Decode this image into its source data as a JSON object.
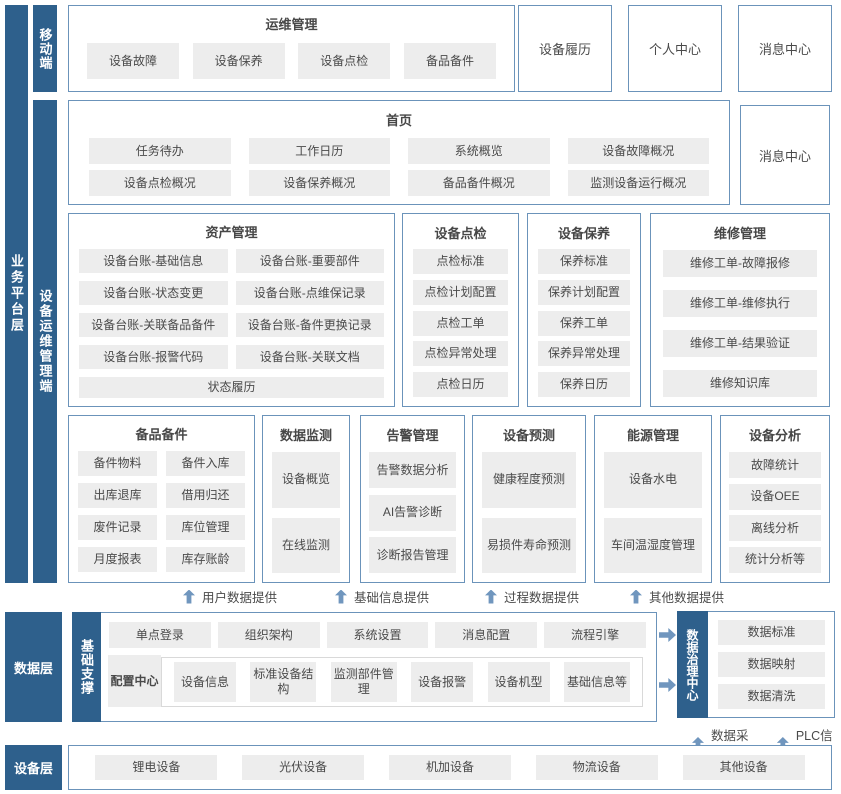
{
  "colors": {
    "dark_blue": "#2e608c",
    "border_blue": "#6b93ba",
    "item_gray": "#ededed",
    "arrow_blue": "#7096be"
  },
  "bars": {
    "business": "业务平台层",
    "mobile": "移动端",
    "ops": "设备运维管理端"
  },
  "yunwei": {
    "title": "运维管理",
    "items": [
      "设备故障",
      "设备保养",
      "设备点检",
      "备品备件"
    ]
  },
  "top_boxes": {
    "b0": "设备履历",
    "b1": "个人中心",
    "b2": "消息中心"
  },
  "home": {
    "title": "首页",
    "items": [
      "任务待办",
      "工作日历",
      "系统概览",
      "设备故障概况",
      "设备点检概况",
      "设备保养概况",
      "备品备件概况",
      "监测设备运行概况"
    ],
    "side": "消息中心"
  },
  "asset": {
    "title": "资产管理",
    "items": [
      "设备台账-基础信息",
      "设备台账-重要部件",
      "设备台账-状态变更",
      "设备台账-点维保记录",
      "设备台账-关联备品备件",
      "设备台账-备件更换记录",
      "设备台账-报警代码",
      "设备台账-关联文档"
    ],
    "wide": "状态履历"
  },
  "dianjian": {
    "title": "设备点检",
    "items": [
      "点检标准",
      "点检计划配置",
      "点检工单",
      "点检异常处理",
      "点检日历"
    ]
  },
  "baoyang": {
    "title": "设备保养",
    "items": [
      "保养标准",
      "保养计划配置",
      "保养工单",
      "保养异常处理",
      "保养日历"
    ]
  },
  "weixiu": {
    "title": "维修管理",
    "items": [
      "维修工单-故障报修",
      "维修工单-维修执行",
      "维修工单-结果验证",
      "维修知识库"
    ]
  },
  "beipin": {
    "title": "备品备件",
    "items": [
      "备件物料",
      "备件入库",
      "出库退库",
      "借用归还",
      "废件记录",
      "库位管理",
      "月度报表",
      "库存账龄"
    ]
  },
  "jiance": {
    "title": "数据监测",
    "items": [
      "设备概览",
      "在线监测"
    ]
  },
  "gaojing": {
    "title": "告警管理",
    "items": [
      "告警数据分析",
      "AI告警诊断",
      "诊断报告管理"
    ]
  },
  "yuce": {
    "title": "设备预测",
    "items": [
      "健康程度预测",
      "易损件寿命预测"
    ]
  },
  "nengyuan": {
    "title": "能源管理",
    "items": [
      "设备水电",
      "车间温湿度管理"
    ]
  },
  "fenxi": {
    "title": "设备分析",
    "items": [
      "故障统计",
      "设备OEE",
      "离线分析",
      "统计分析等"
    ]
  },
  "flows": [
    "用户数据提供",
    "基础信息提供",
    "过程数据提供",
    "其他数据提供"
  ],
  "data_layer": {
    "label": "数据层",
    "support": "基础支撑",
    "row1": [
      "单点登录",
      "组织架构",
      "系统设置",
      "消息配置",
      "流程引擎"
    ],
    "config": "配置中心",
    "config_items": [
      "设备信息",
      "标准设备结构",
      "监测部件管理",
      "设备报警",
      "设备机型",
      "基础信息等"
    ],
    "governance": "数据治理中心",
    "gov_items": [
      "数据标准",
      "数据映射",
      "数据清洗"
    ],
    "collect": [
      "数据采集",
      "PLC信号"
    ]
  },
  "device_layer": {
    "label": "设备层",
    "items": [
      "锂电设备",
      "光伏设备",
      "机加设备",
      "物流设备",
      "其他设备"
    ]
  }
}
